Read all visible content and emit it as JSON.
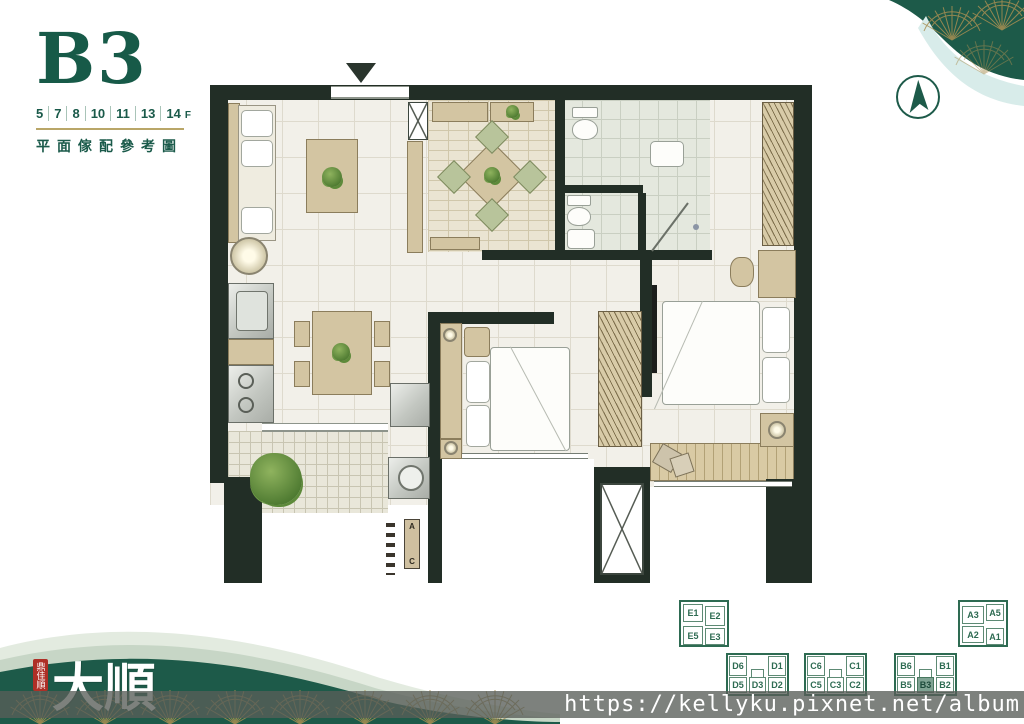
{
  "header": {
    "unit_code": "B3",
    "floors": [
      "5",
      "7",
      "8",
      "10",
      "11",
      "13",
      "14"
    ],
    "floor_suffix": "F",
    "subtitle": "平面傢配參考圖"
  },
  "plan": {
    "ac_label_top": "A",
    "ac_label_bottom": "C"
  },
  "unit_maps": {
    "e": {
      "cells": [
        "E1",
        "E2",
        "E5",
        "E3"
      ]
    },
    "a": {
      "cells": [
        "A3",
        "A5",
        "A2",
        "A1"
      ]
    },
    "d": {
      "top": [
        "D6",
        "D1"
      ],
      "bottom": [
        "D5",
        "D3",
        "D2"
      ]
    },
    "c": {
      "top": [
        "C6",
        "C1"
      ],
      "bottom": [
        "C5",
        "C3",
        "C2"
      ]
    },
    "b": {
      "top": [
        "B6",
        "B1"
      ],
      "bottom": [
        "B5",
        "B3",
        "B2"
      ],
      "highlighted": "B3"
    }
  },
  "logo": {
    "seal": "鼎佳順",
    "name": "大順"
  },
  "watermark": {
    "url": "https://kellyku.pixnet.net/album"
  },
  "colors": {
    "brand_green": "#1a5a4a",
    "deco_green": "#1d5a49",
    "deco_gold": "#a98f52",
    "teal_wave": "#d8ecea",
    "wall": "#222e26",
    "highlight_cell": "#7fa393"
  }
}
